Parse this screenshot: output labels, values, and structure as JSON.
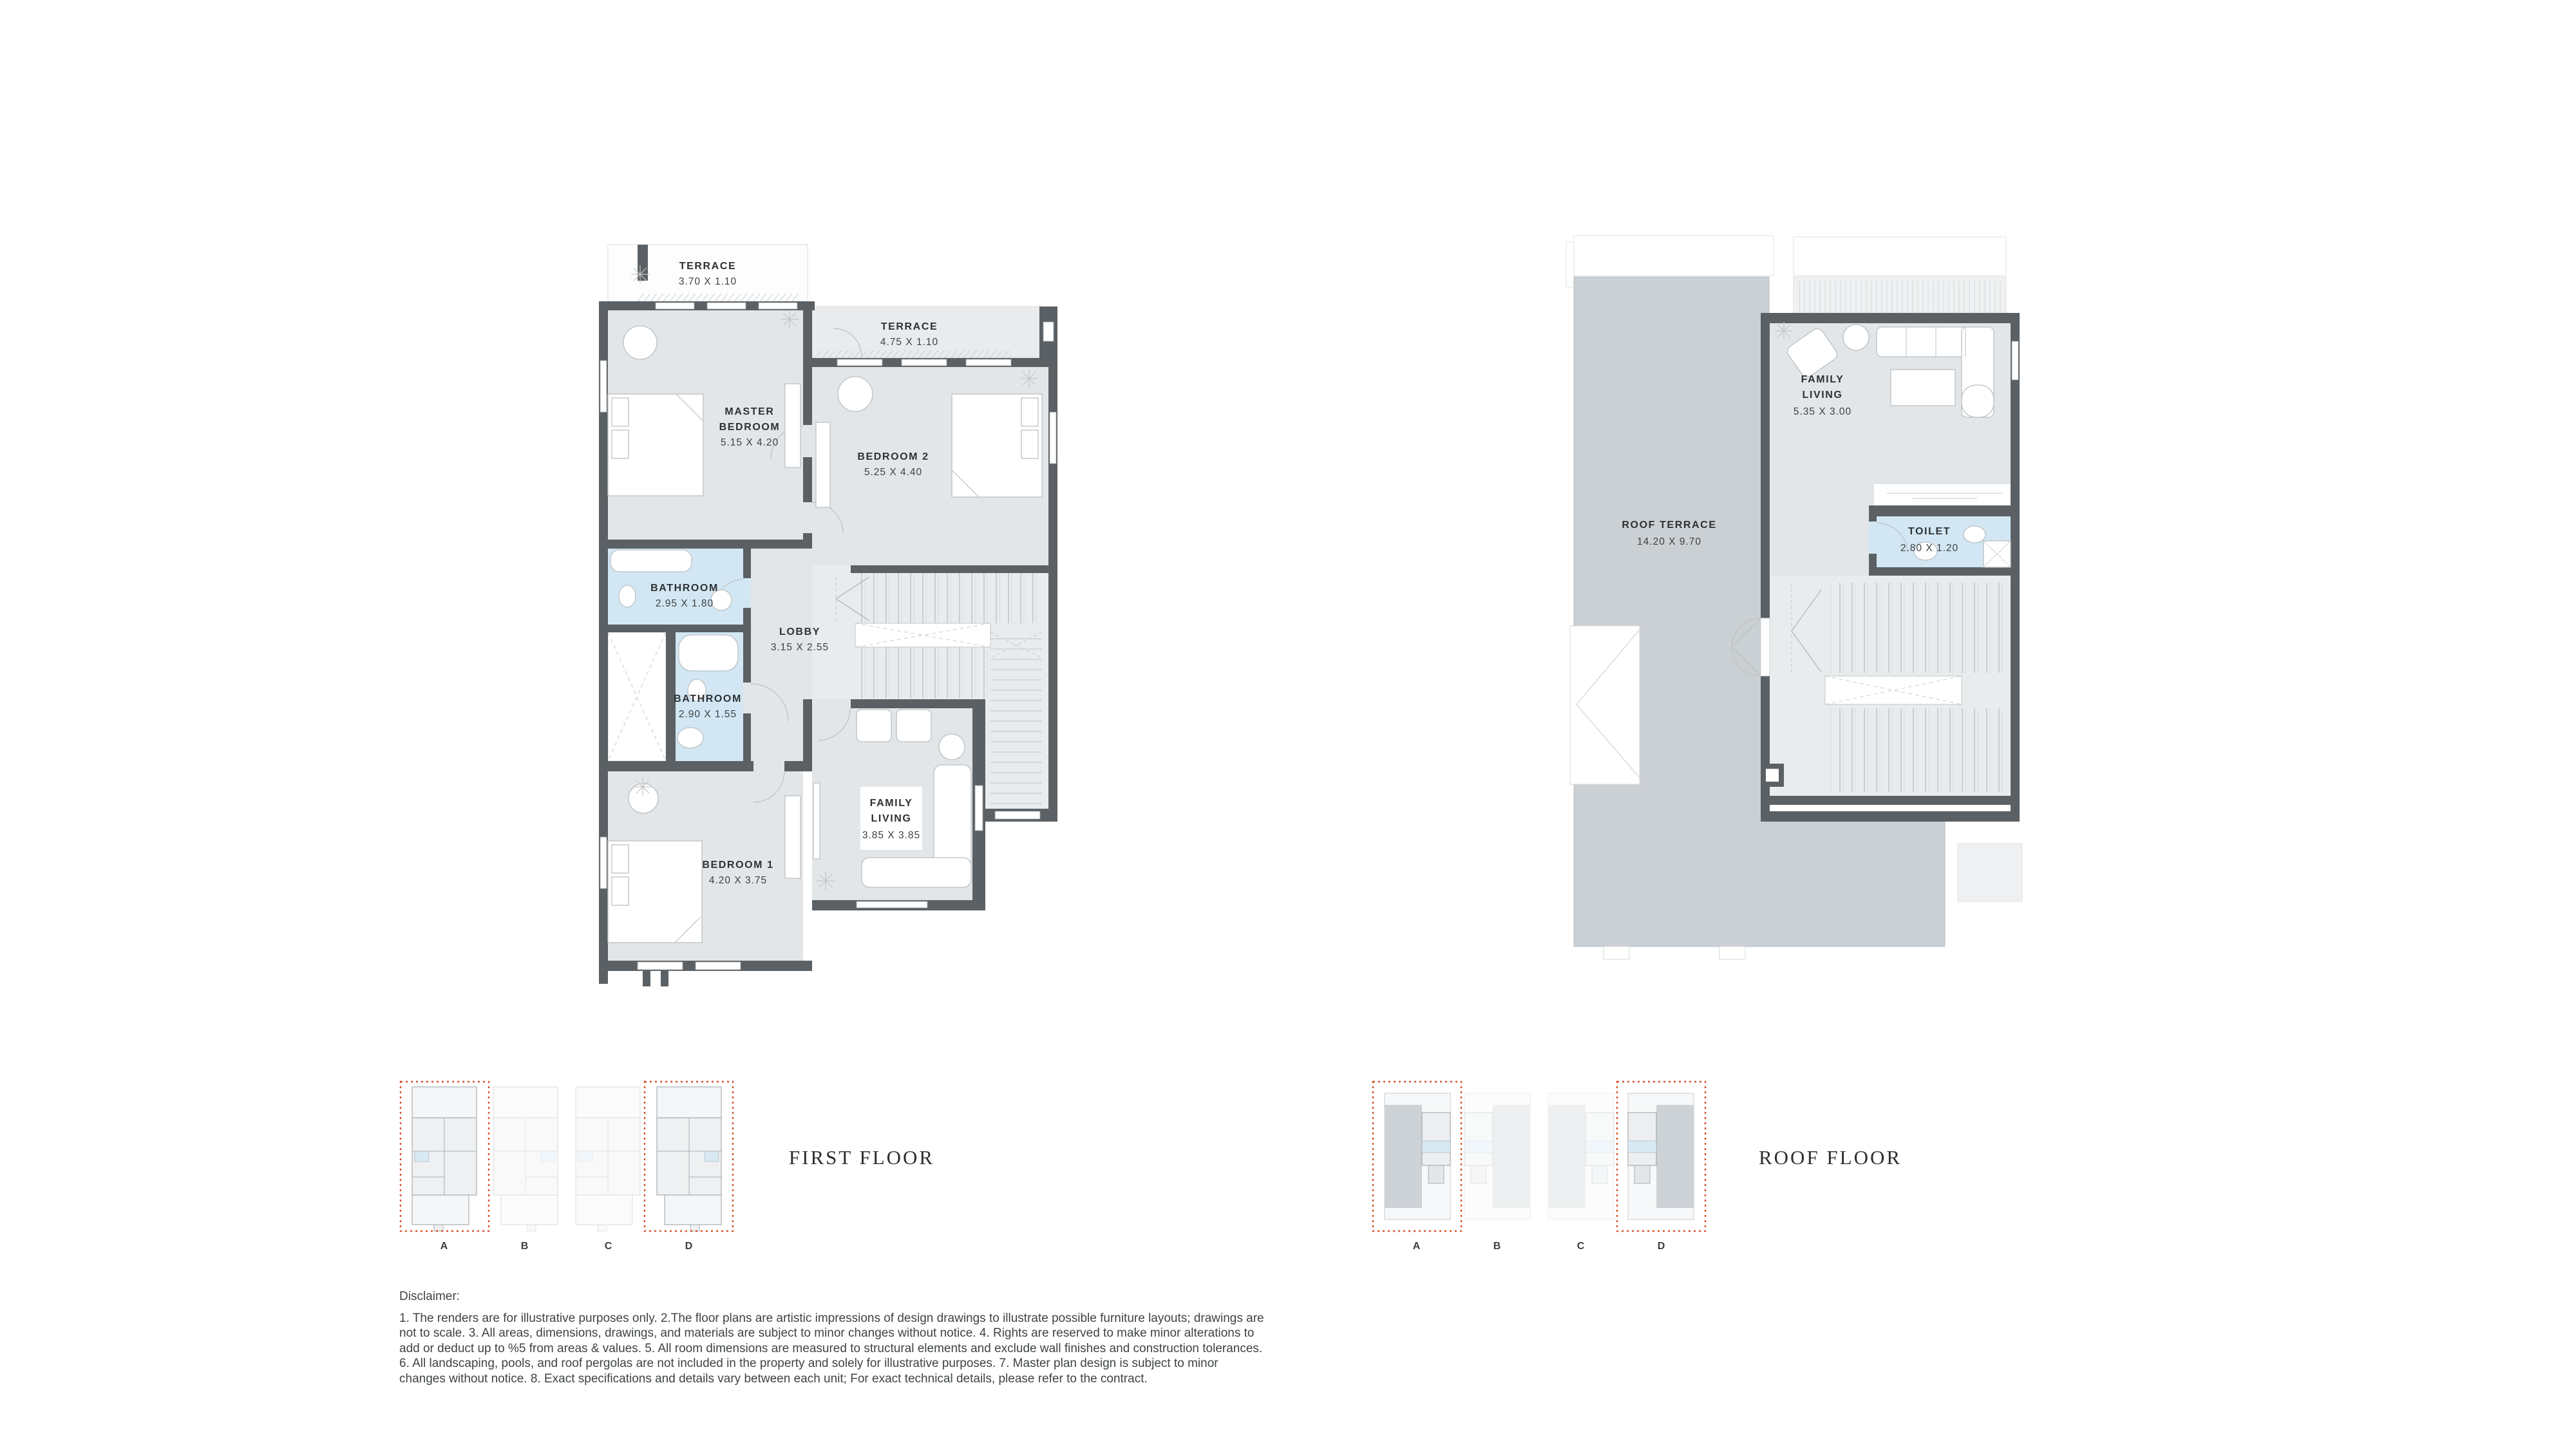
{
  "document": {
    "background": "#ffffff"
  },
  "colors": {
    "wall": "#5b6064",
    "room_fill": "#e3e6e8",
    "stair_fill": "#e9eced",
    "terrace_white": "#fdfdfd",
    "terrace_light": "#e9ebed",
    "roof_terrace_fill": "#cbd0d4",
    "bathroom_fill": "#d2e7f3",
    "keyplan_highlight_red": "#d9512e",
    "label_dark": "#2e3133",
    "label_dim": "#3d4144"
  },
  "first_floor": {
    "title": "FIRST FLOOR",
    "rooms": [
      {
        "id": "terrace-1",
        "name_lines": [
          "TERRACE"
        ],
        "dims": "3.70 X 1.10"
      },
      {
        "id": "terrace-2",
        "name_lines": [
          "TERRACE"
        ],
        "dims": "4.75 X 1.10"
      },
      {
        "id": "master-bedroom",
        "name_lines": [
          "MASTER",
          "BEDROOM"
        ],
        "dims": "5.15 X 4.20"
      },
      {
        "id": "bedroom-2",
        "name_lines": [
          "BEDROOM 2"
        ],
        "dims": "5.25 X 4.40"
      },
      {
        "id": "bathroom-1",
        "name_lines": [
          "BATHROOM"
        ],
        "dims": "2.95 X 1.80"
      },
      {
        "id": "lobby",
        "name_lines": [
          "LOBBY"
        ],
        "dims": "3.15 X 2.55"
      },
      {
        "id": "bathroom-2",
        "name_lines": [
          "BATHROOM"
        ],
        "dims": "2.90 X 1.55"
      },
      {
        "id": "bedroom-1",
        "name_lines": [
          "BEDROOM 1"
        ],
        "dims": "4.20 X 3.75"
      },
      {
        "id": "family-living",
        "name_lines": [
          "FAMILY",
          "LIVING"
        ],
        "dims": "3.85 X 3.85"
      }
    ],
    "keyplan": {
      "units": [
        "A",
        "B",
        "C",
        "D"
      ],
      "highlighted_units": "A, D"
    }
  },
  "roof_floor": {
    "title": "ROOF FLOOR",
    "rooms": [
      {
        "id": "roof-terrace",
        "name_lines": [
          "ROOF TERRACE"
        ],
        "dims": "14.20 X 9.70"
      },
      {
        "id": "family-living",
        "name_lines": [
          "FAMILY",
          "LIVING"
        ],
        "dims": "5.35 X 3.00"
      },
      {
        "id": "toilet",
        "name_lines": [
          "TOILET"
        ],
        "dims": "2.80 X 1.20"
      }
    ],
    "keyplan": {
      "units": [
        "A",
        "B",
        "C",
        "D"
      ],
      "highlighted_units": "A, D"
    }
  },
  "disclaimer": {
    "heading": "Disclaimer:",
    "body": "1. The renders are for illustrative purposes only. 2.The floor plans are artistic impressions of design drawings to illustrate possible furniture layouts; drawings are not to scale. 3. All areas, dimensions, drawings, and materials are subject to minor changes without notice. 4. Rights are reserved to make minor alterations to add or deduct up to %5 from areas & values. 5. All room dimensions are measured to structural elements and exclude wall finishes and construction tolerances. 6. All landscaping, pools, and roof pergolas are not included in the property and solely for illustrative purposes. 7. Master plan design is subject to minor changes without notice. 8. Exact specifications and details vary between each unit; For exact technical details, please refer to the contract."
  }
}
